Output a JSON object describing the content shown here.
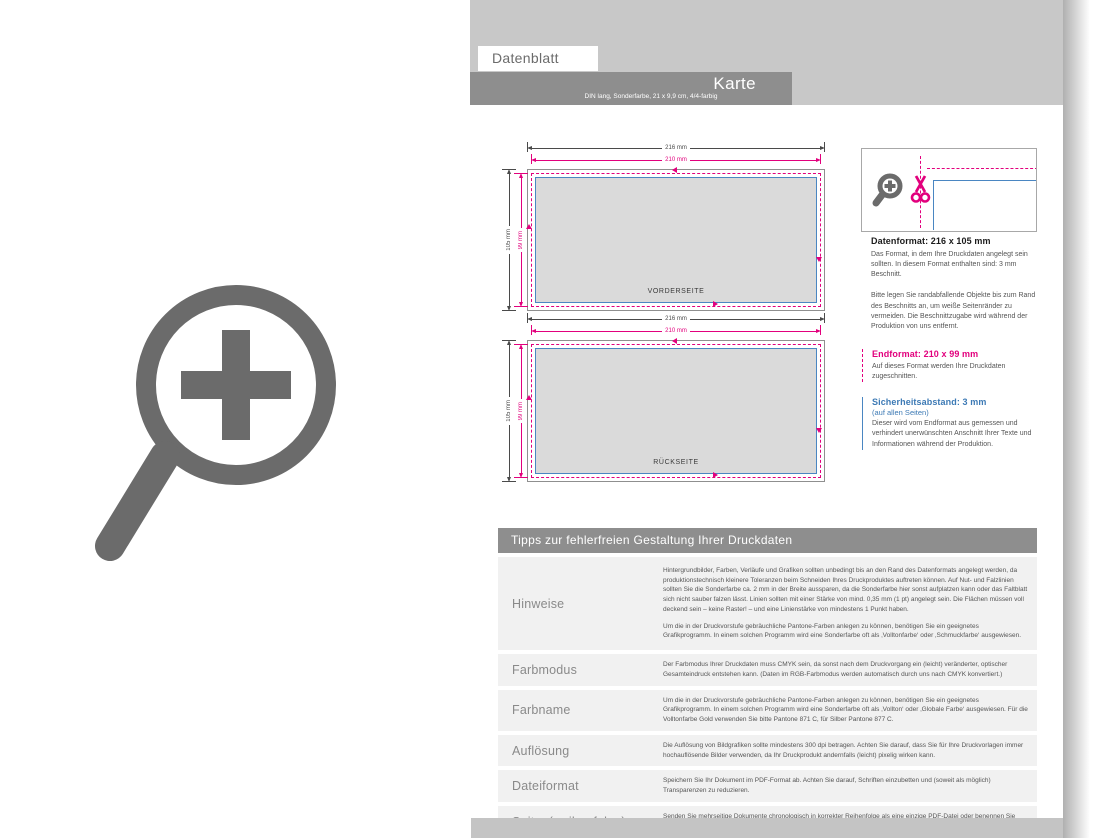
{
  "header": {
    "tab": "Datenblatt",
    "title": "Karte",
    "subtitle": "DIN lang, Sonderfarbe, 21 x 9,9 cm, 4/4-farbig"
  },
  "diagram": {
    "front_label": "VORDERSEITE",
    "back_label": "RÜCKSEITE",
    "dim_outer_width": "216 mm",
    "dim_trim_width": "210 mm",
    "dim_outer_height": "105 mm",
    "dim_trim_height": "99 mm"
  },
  "info_panel": {
    "datenformat": {
      "title": "Datenformat: 216 x 105 mm",
      "p1": "Das Format, in dem Ihre Druckdaten angelegt sein sollten. In diesem Format enthalten sind: 3 mm Beschnitt.",
      "p2": "Bitte legen Sie randabfallende Objekte bis zum Rand des Beschnitts an, um weiße Seitenränder zu vermeiden. Die Beschnittzugabe wird während der Produktion von uns entfernt."
    },
    "endformat": {
      "title": "Endformat: 210 x 99 mm",
      "p": "Auf dieses Format werden Ihre Druckdaten zugeschnitten."
    },
    "sicherheitsabstand": {
      "title": "Sicherheitsabstand: 3 mm",
      "subtitle": "(auf allen Seiten)",
      "p": "Dieser wird vom Endformat aus gemessen und verhindert unerwünschten Anschnitt Ihrer Texte und Informationen während der Produktion."
    }
  },
  "tips": {
    "header": "Tipps zur fehlerfreien Gestaltung Ihrer Druckdaten",
    "rows": [
      {
        "label": "Hinweise",
        "paragraphs": [
          "Hintergrundbilder, Farben, Verläufe und Grafiken sollten unbedingt bis an den Rand des Datenformats angelegt werden, da produktionstechnisch kleinere Toleranzen beim Schneiden Ihres Druckproduktes auftreten können. Auf Nut- und Falzlinien sollten Sie die Sonderfarbe ca. 2 mm in der Breite aussparen, da die Sonderfarbe hier sonst aufplatzen kann oder das Faltblatt sich nicht sauber falzen lässt. Linien sollten mit einer Stärke von mind. 0,35 mm (1 pt) angelegt sein. Die Flächen müssen voll deckend sein – keine Raster! – und eine Linienstärke von mindestens 1 Punkt haben.",
          "Um die in der Druckvorstufe gebräuchliche Pantone-Farben anlegen zu können, benötigen Sie ein geeignetes Grafikprogramm. In einem solchen Programm wird eine Sonderfarbe oft als ‚Volltonfarbe‘ oder ‚Schmuckfarbe‘ ausgewiesen."
        ]
      },
      {
        "label": "Farbmodus",
        "paragraphs": [
          "Der Farbmodus Ihrer Druckdaten muss CMYK sein, da sonst nach dem Druckvorgang ein (leicht) veränderter, optischer Gesamteindruck entstehen kann. (Daten im RGB-Farbmodus werden automatisch durch uns nach CMYK konvertiert.)"
        ]
      },
      {
        "label": "Farbname",
        "paragraphs": [
          "Um die in der Druckvorstufe gebräuchliche Pantone-Farben anlegen zu können, benötigen Sie ein geeignetes Grafikprogramm. In einem solchen Programm wird eine Sonderfarbe oft als ‚Vollton‘ oder ‚Globale Farbe‘ ausgewiesen. Für die Volltonfarbe Gold verwenden Sie bitte Pantone 871 C, für Silber Pantone 877 C."
        ]
      },
      {
        "label": "Auflösung",
        "paragraphs": [
          "Die Auflösung von Bildgrafiken sollte mindestens 300 dpi betragen. Achten Sie darauf, dass Sie für Ihre Druckvorlagen immer hochauflösende Bilder verwenden, da Ihr Druckprodukt andernfalls (leicht) pixelig wirken kann."
        ]
      },
      {
        "label": "Dateiformat",
        "paragraphs": [
          "Speichern Sie Ihr Dokument im PDF-Format ab. Achten Sie darauf, Schriften einzubetten und (soweit als möglich) Transparenzen zu reduzieren."
        ]
      },
      {
        "label": "Seiten(-reihenfolge)",
        "paragraphs": [
          "Senden Sie mehrseitige Dokumente chronologisch in korrekter Reihenfolge als eine einzige PDF-Datei oder benennen Sie Einzeldokumente entsprechend mit fortlaufenden Seitennummern."
        ]
      }
    ]
  },
  "colors": {
    "accent_magenta": "#e2007d",
    "accent_blue": "#4a86c2",
    "banner_gray": "#8e8e8e",
    "band_gray": "#c8c8c8",
    "icon_gray": "#6b6b6b"
  },
  "icons": {
    "zoom_cursor": "magnifier-plus",
    "zoom_preview": "magnifier-plus",
    "cut_marker": "scissors"
  }
}
